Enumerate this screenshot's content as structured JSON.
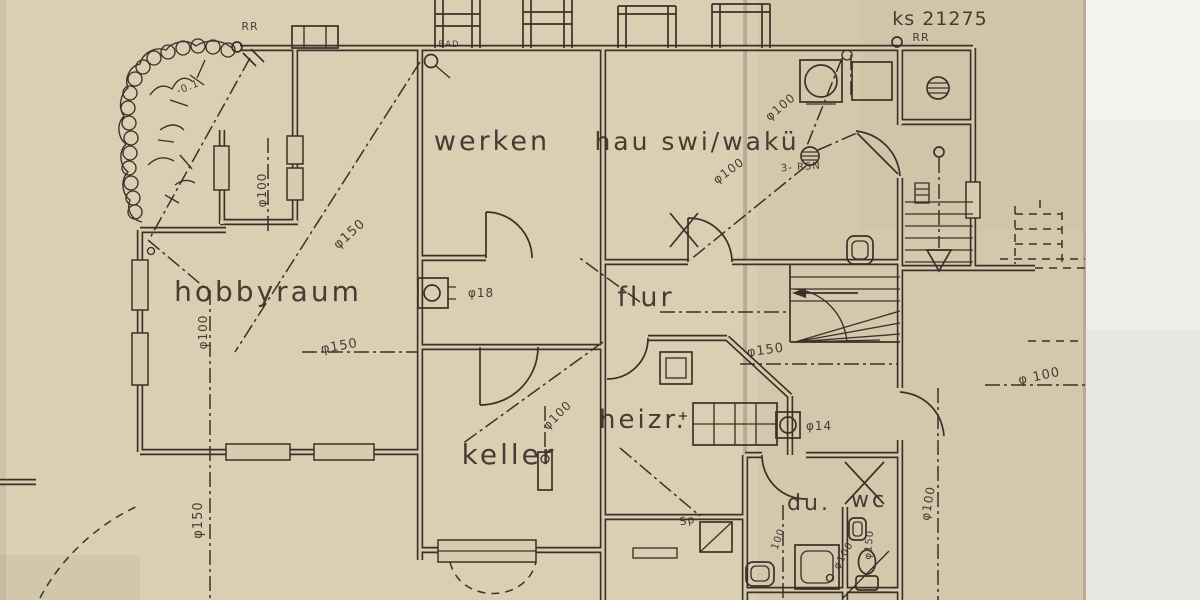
{
  "drawing": {
    "number": {
      "text": "ks 21275"
    },
    "rooms": [
      {
        "id": "werken",
        "text": "werken"
      },
      {
        "id": "hauswi",
        "text": "hau swi/wakü"
      },
      {
        "id": "hobbyraum",
        "text": "hobbyraum"
      },
      {
        "id": "flur",
        "text": "flur"
      },
      {
        "id": "heizr",
        "text": "heizr."
      },
      {
        "id": "keller",
        "text": "keller"
      },
      {
        "id": "du",
        "text": "du."
      },
      {
        "id": "wc",
        "text": "wc"
      }
    ],
    "annotations": {
      "rr_left": "RR",
      "rr_right": "RR",
      "bad": "BAD",
      "rsn": "3- RSN",
      "sp": "Sp",
      "level": "-0.1"
    },
    "pipes": [
      {
        "text": "φ100"
      },
      {
        "text": "φ100"
      },
      {
        "text": "φ150"
      },
      {
        "text": "φ150"
      },
      {
        "text": "φ100"
      },
      {
        "text": "φ100"
      },
      {
        "text": "φ100"
      },
      {
        "text": "φ150"
      },
      {
        "text": "φ150"
      },
      {
        "text": "φ100"
      },
      {
        "text": "φ 100"
      },
      {
        "text": "φ18"
      },
      {
        "text": "φ14"
      },
      {
        "text": "100"
      },
      {
        "text": "φ100"
      },
      {
        "text": "φ150"
      }
    ],
    "colors": {
      "paper_left": "#dbceb3",
      "paper_right": "#d4c7ab",
      "paper_edge_strip": "#efede8",
      "ink": "#3a3129"
    }
  }
}
